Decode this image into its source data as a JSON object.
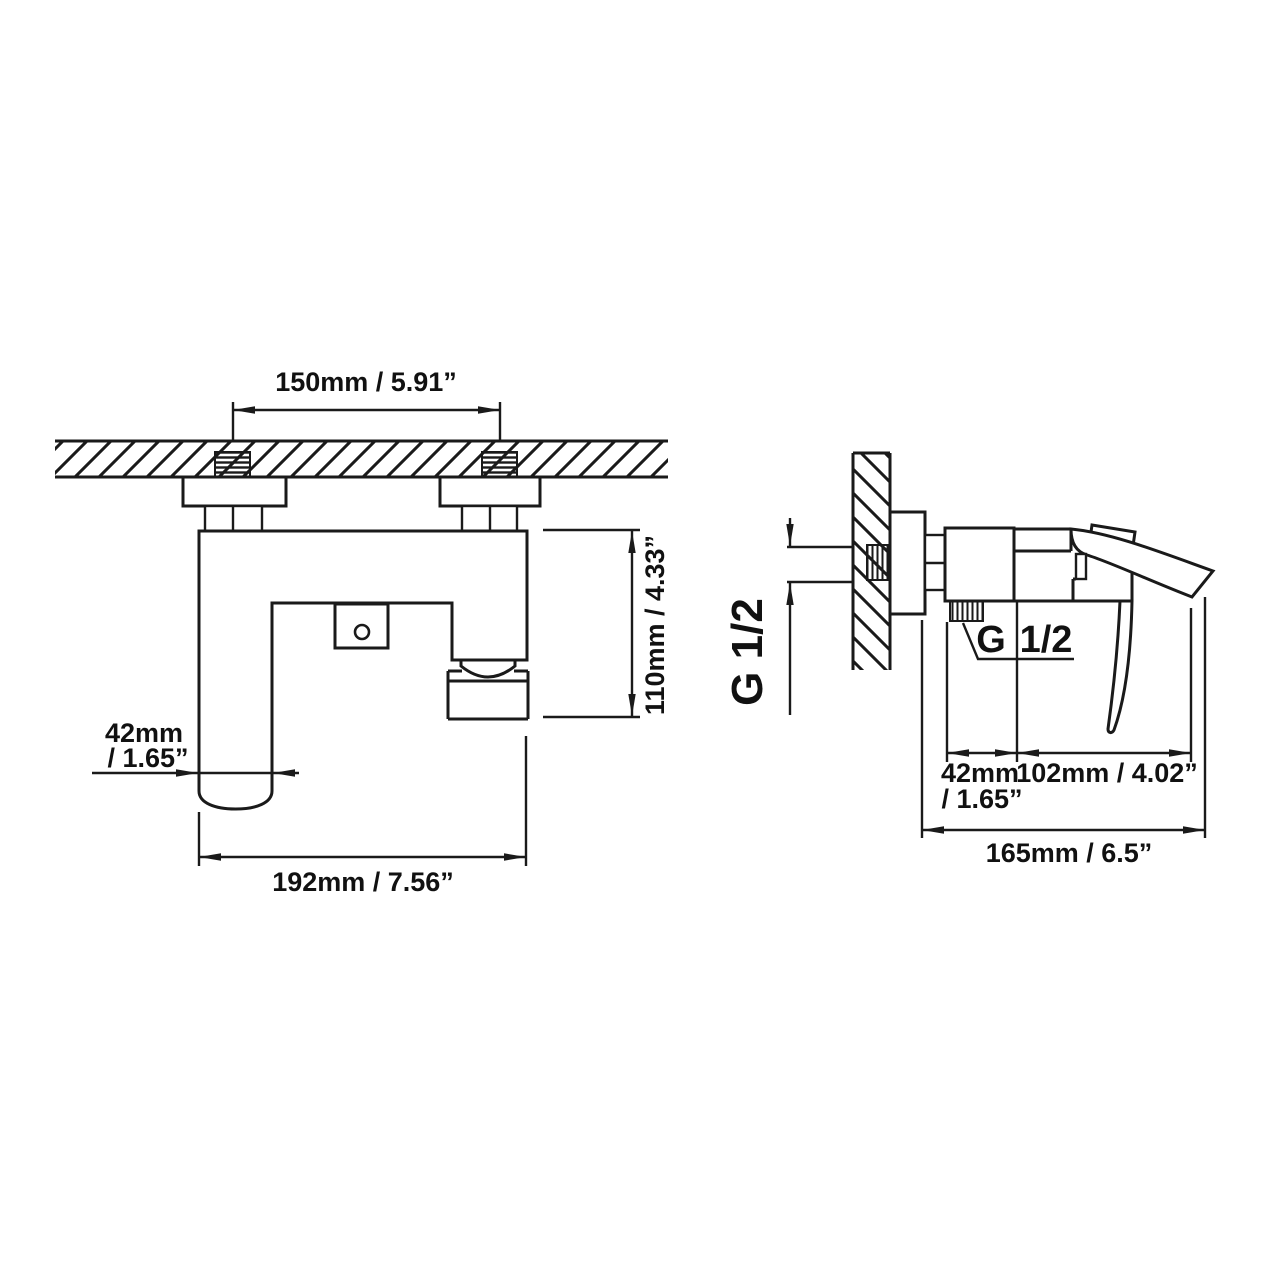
{
  "drawing": {
    "front_view": {
      "dim_hole_spacing": "150mm / 5.91”",
      "dim_height": "110mm / 4.33”",
      "dim_spout_width_line1": "42mm",
      "dim_spout_width_line2": "/ 1.65”",
      "dim_overall_width": "192mm / 7.56”"
    },
    "side_view": {
      "thread_size_rotated": "G 1/2",
      "thread_size_g": "G",
      "thread_size_half": "1/2",
      "dim_body_depth_line1": "42mm",
      "dim_body_depth_line2": "/ 1.65”",
      "dim_spout_reach": "102mm / 4.02”",
      "dim_overall_depth": "165mm / 6.5”"
    },
    "colors": {
      "line": "#1a1a1a",
      "background": "#ffffff"
    }
  }
}
